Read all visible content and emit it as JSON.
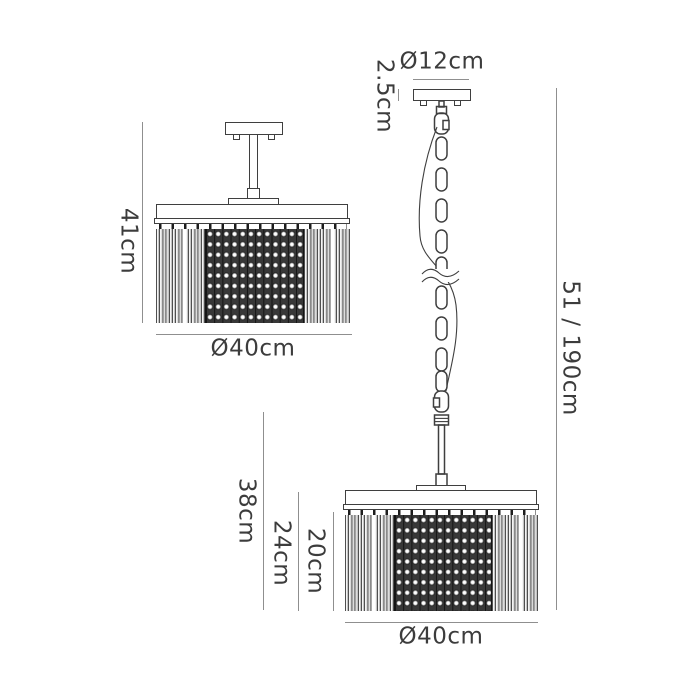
{
  "page": {
    "background": "#ffffff"
  },
  "palette": {
    "outline": "#3f3f3f",
    "dim_line": "#8f8f8f",
    "text": "#3c3c3c",
    "mesh_dark": "#383838"
  },
  "views": {
    "semi_flush": {
      "name": "Semi-flush ceiling fitting — front elevation",
      "labels": {
        "height": "41cm",
        "diameter": "Ø40cm"
      }
    },
    "pendant": {
      "name": "Chain pendant fitting — front elevation",
      "labels": {
        "canopy_diameter": "Ø12cm",
        "canopy_height": "2.5cm",
        "overall_drop": "51 / 190cm",
        "shade_overall_height": "38cm",
        "shade_body_height": "24cm",
        "rod_drop_height": "20cm",
        "shade_diameter": "Ø40cm"
      }
    }
  }
}
